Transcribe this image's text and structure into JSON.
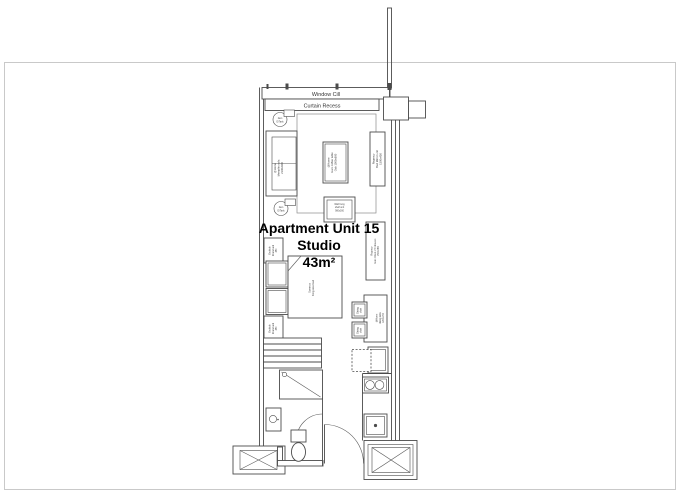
{
  "unit": {
    "title": "Apartment Unit 15",
    "type": "Studio",
    "area": "43m²"
  },
  "labels": {
    "window_cill": "Window Cill",
    "curtain_recess": "Curtain Recess"
  },
  "furniture": {
    "ceiling_light_top": {
      "l1": "2am",
      "l2": "D/Task"
    },
    "ceiling_light_bottom": {
      "l1": "2am",
      "l2": "D/Task"
    },
    "sofa": {
      "l1": "@Home",
      "l2": "Memphis sofa",
      "l3": "2100x900"
    },
    "coffee_table": {
      "l1": "@Home",
      "l2": "Euro coffee table",
      "l3": "Oak 1000x600"
    },
    "mirror_unit": {
      "l1": "Regency",
      "l2": "Bed Mirror unit",
      "l3": "1500x450"
    },
    "shelf_unit": {
      "l1": "Wall hung",
      "l2": "shelf unit",
      "l3": "900x300"
    },
    "chest_of_drawers": {
      "l1": "Regency",
      "l2": "Euro Chest of 6 drawers",
      "l3": "1500x450"
    },
    "bed": {
      "l1": "Somnus",
      "l2": "King size bed"
    },
    "bedside_unit_top": {
      "l1": "Bedside",
      "l2": "Round unit",
      "l3": "450"
    },
    "bedside_unit_bottom": {
      "l1": "Bedside",
      "l2": "Round unit",
      "l3": "450"
    },
    "dining_table": {
      "l1": "@Home",
      "l2": "dining table",
      "l3": "1200x700"
    },
    "dining_chair_1": {
      "l1": "Dining",
      "l2": "chair"
    },
    "dining_chair_2": {
      "l1": "Dining",
      "l2": "chair"
    }
  }
}
